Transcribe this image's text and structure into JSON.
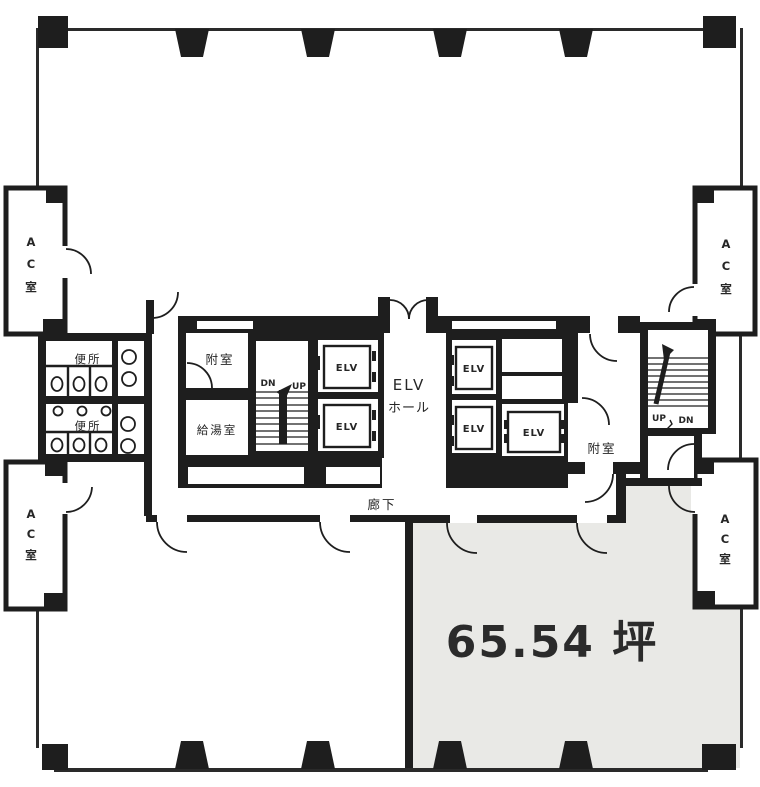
{
  "plan": {
    "labels": {
      "ac_chars": [
        "A",
        "C",
        "室"
      ],
      "toilet": "便所",
      "vestibule": "附室",
      "kitchenette": "給湯室",
      "elevator": "ELV",
      "elv_hall_line1": "ELV",
      "elv_hall_line2": "ホール",
      "corridor": "廊下",
      "up": "UP",
      "dn": "DN",
      "area": "65.54 坪"
    },
    "colors": {
      "wall": "#1e1e1e",
      "tenant_fill": "#e9e9e6",
      "paper": "#ffffff",
      "label": "#262626"
    }
  }
}
